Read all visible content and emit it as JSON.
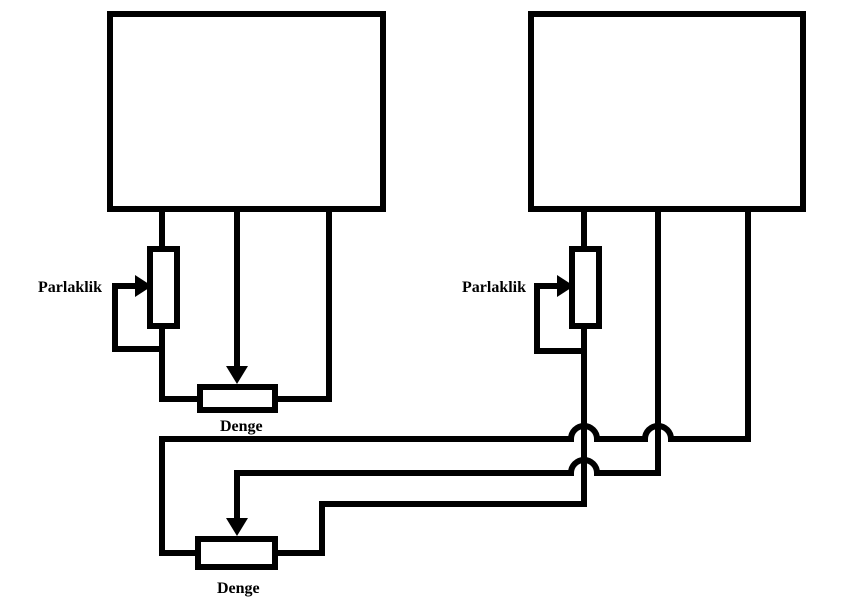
{
  "diagram": {
    "background_color": "#ffffff",
    "line_color": "#000000",
    "left_circuit": {
      "brightness_label": "Parlaklik",
      "balance_label": "Denge"
    },
    "right_circuit": {
      "brightness_label": "Parlaklik",
      "balance_label": "Denge"
    }
  }
}
